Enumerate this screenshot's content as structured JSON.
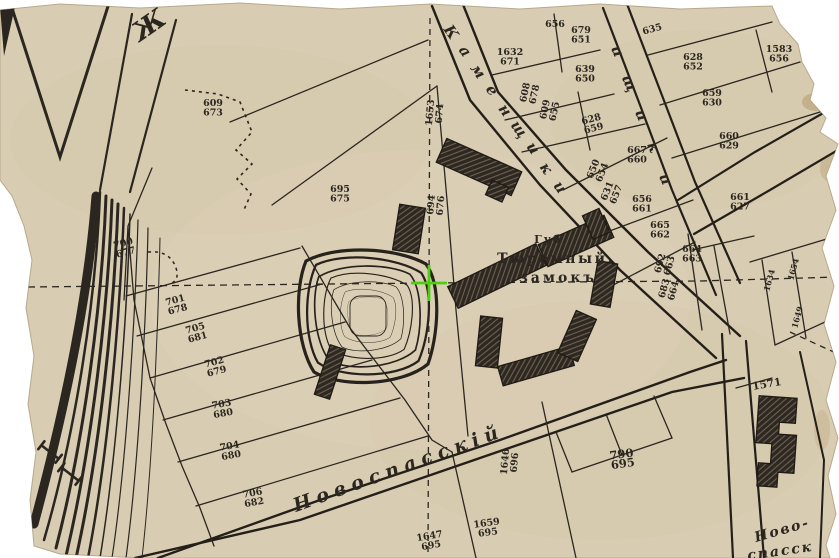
{
  "map": {
    "prison": {
      "line1": "Губ.",
      "line2": "Тюремный.",
      "line3": "замокъ"
    },
    "street_novospassky": "Новоспасскій",
    "street_novo_line1": "Ново-",
    "street_novo_line2": "спасск",
    "corner_letter": "Ж",
    "building_1571_label": "1571",
    "street_letters": {
      "kamenshchiki_left": [
        "К",
        "а",
        "м",
        "е",
        "н",
        "щ",
        "и",
        "к",
        "и"
      ],
      "kamenshchiki_right": [
        "и",
        "щ",
        "и",
        "к",
        "и"
      ]
    },
    "colors": {
      "paper": "#d8ccb2",
      "ink": "#2b261f",
      "building": "#2e2822",
      "cursor_green": "#4ad00c"
    },
    "cursor": {
      "x": 429,
      "y": 283
    },
    "plots": [
      {
        "top": "609",
        "bottom": "673",
        "x": 213,
        "y": 106,
        "r": 0
      },
      {
        "top": "1653",
        "bottom": "674",
        "x": 433,
        "y": 113,
        "r": -85
      },
      {
        "top": "1632",
        "bottom": "671",
        "x": 510,
        "y": 55,
        "r": 0
      },
      {
        "top": "656",
        "bottom": "",
        "x": 555,
        "y": 27,
        "r": 0
      },
      {
        "top": "679",
        "bottom": "651",
        "x": 581,
        "y": 33,
        "r": 0
      },
      {
        "top": "608",
        "bottom": "678",
        "x": 528,
        "y": 93,
        "r": -78
      },
      {
        "top": "609",
        "bottom": "655",
        "x": 548,
        "y": 110,
        "r": -78
      },
      {
        "top": "639",
        "bottom": "650",
        "x": 585,
        "y": 72,
        "r": 0
      },
      {
        "top": "628",
        "bottom": "659",
        "x": 592,
        "y": 122,
        "r": -15
      },
      {
        "top": "694",
        "bottom": "676",
        "x": 434,
        "y": 205,
        "r": -85
      },
      {
        "top": "695",
        "bottom": "675",
        "x": 340,
        "y": 192,
        "r": 0
      },
      {
        "top": "667",
        "bottom": "660",
        "x": 637,
        "y": 153,
        "r": 0
      },
      {
        "top": "650",
        "bottom": "654",
        "x": 596,
        "y": 170,
        "r": -68
      },
      {
        "top": "631",
        "bottom": "657",
        "x": 610,
        "y": 192,
        "r": -68
      },
      {
        "top": "656",
        "bottom": "661",
        "x": 642,
        "y": 202,
        "r": 0
      },
      {
        "top": "665",
        "bottom": "662",
        "x": 660,
        "y": 228,
        "r": 0
      },
      {
        "top": "692",
        "bottom": "663",
        "x": 663,
        "y": 264,
        "r": -75
      },
      {
        "top": "683",
        "bottom": "664",
        "x": 667,
        "y": 289,
        "r": -75
      },
      {
        "top": "635",
        "bottom": "",
        "x": 653,
        "y": 32,
        "r": -15
      },
      {
        "top": "628",
        "bottom": "652",
        "x": 693,
        "y": 60,
        "r": 0
      },
      {
        "top": "1583",
        "bottom": "656",
        "x": 779,
        "y": 52,
        "r": 0
      },
      {
        "top": "659",
        "bottom": "630",
        "x": 712,
        "y": 96,
        "r": 0
      },
      {
        "top": "660",
        "bottom": "629",
        "x": 729,
        "y": 139,
        "r": 0
      },
      {
        "top": "661",
        "bottom": "627",
        "x": 740,
        "y": 200,
        "r": 0
      },
      {
        "top": "664",
        "bottom": "663",
        "x": 692,
        "y": 252,
        "r": 0
      },
      {
        "top": "1634",
        "bottom": "",
        "x": 772,
        "y": 281,
        "r": -75,
        "fs": 8
      },
      {
        "top": "1654",
        "bottom": "",
        "x": 796,
        "y": 270,
        "r": -75,
        "fs": 8
      },
      {
        "top": "1649",
        "bottom": "",
        "x": 800,
        "y": 318,
        "r": -75,
        "fs": 8
      },
      {
        "top": "700",
        "bottom": "677",
        "x": 124,
        "y": 246,
        "r": -15
      },
      {
        "top": "701",
        "bottom": "678",
        "x": 176,
        "y": 303,
        "r": -15
      },
      {
        "top": "705",
        "bottom": "681",
        "x": 196,
        "y": 331,
        "r": -15
      },
      {
        "top": "702",
        "bottom": "679",
        "x": 215,
        "y": 365,
        "r": -15
      },
      {
        "top": "703",
        "bottom": "680",
        "x": 222,
        "y": 407,
        "r": -10
      },
      {
        "top": "704",
        "bottom": "680",
        "x": 230,
        "y": 449,
        "r": -10
      },
      {
        "top": "706",
        "bottom": "682",
        "x": 253,
        "y": 496,
        "r": -10
      },
      {
        "top": "1646",
        "bottom": "696",
        "x": 508,
        "y": 462,
        "r": -85
      },
      {
        "top": "790",
        "bottom": "695",
        "x": 622,
        "y": 458,
        "r": -8,
        "fs": 11.5
      },
      {
        "top": "1647",
        "bottom": "695",
        "x": 430,
        "y": 539,
        "r": -10
      },
      {
        "top": "1659",
        "bottom": "695",
        "x": 487,
        "y": 526,
        "r": -8
      }
    ]
  }
}
